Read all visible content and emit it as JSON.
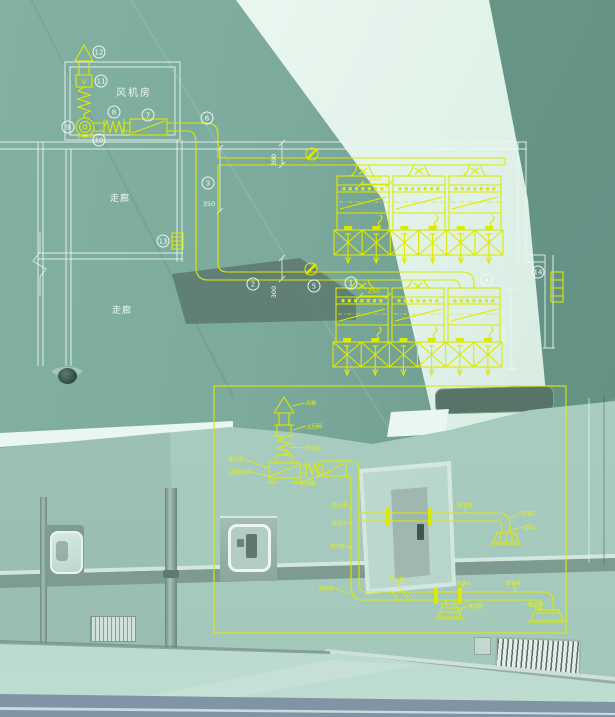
{
  "canvas": {
    "w": 615,
    "h": 717
  },
  "palette": {
    "photo_teal": "#7fae9f",
    "cad_yellow": "#dcea00",
    "cad_white": "#edf7f1"
  },
  "plan": {
    "fan_room": "风机房",
    "valve_letter": "V",
    "corridors": [
      {
        "t": "走廊",
        "x": 120,
        "y": 201
      },
      {
        "t": "走廊",
        "x": 122,
        "y": 313
      }
    ],
    "callouts": [
      {
        "n": "12",
        "x": 99,
        "y": 52
      },
      {
        "n": "11",
        "x": 101,
        "y": 81
      },
      {
        "n": "9",
        "x": 68,
        "y": 127
      },
      {
        "n": "10",
        "x": 99,
        "y": 140
      },
      {
        "n": "8",
        "x": 114,
        "y": 112
      },
      {
        "n": "7",
        "x": 148,
        "y": 115
      },
      {
        "n": "6",
        "x": 207,
        "y": 118
      },
      {
        "n": "3",
        "x": 208,
        "y": 183
      },
      {
        "n": "13",
        "x": 163,
        "y": 241
      },
      {
        "n": "2",
        "x": 253,
        "y": 284
      },
      {
        "n": "5",
        "x": 314,
        "y": 286
      },
      {
        "n": "1",
        "x": 351,
        "y": 283
      },
      {
        "n": "4",
        "x": 487,
        "y": 280
      },
      {
        "n": "14",
        "x": 538,
        "y": 272
      }
    ],
    "dims": [
      {
        "t": "350",
        "x": 209,
        "y": 206,
        "rot": 0,
        "c": "w"
      },
      {
        "t": "300",
        "x": 276,
        "y": 160,
        "rot": -90,
        "c": "w"
      },
      {
        "t": "300",
        "x": 276,
        "y": 292,
        "rot": -90,
        "c": "w"
      },
      {
        "t": "2350",
        "x": 506,
        "y": 334,
        "rot": -90,
        "c": "w"
      },
      {
        "t": "250",
        "x": 375,
        "y": 181,
        "rot": 0,
        "c": "y"
      },
      {
        "t": "250",
        "x": 374,
        "y": 293,
        "rot": 0,
        "c": "y"
      }
    ]
  },
  "detail": {
    "labels": [
      {
        "t": "风帽",
        "x": 306,
        "y": 405,
        "a": "start",
        "lx": 292,
        "ly": 406
      },
      {
        "t": "止回阀",
        "x": 307,
        "y": 428,
        "a": "start",
        "lx": 293,
        "ly": 430
      },
      {
        "t": "软接头",
        "x": 306,
        "y": 450,
        "a": "start",
        "lx": 291,
        "ly": 447
      },
      {
        "t": "排风机",
        "x": 243,
        "y": 461,
        "a": "end",
        "lx": 268,
        "ly": 468
      },
      {
        "t": "减震吊架",
        "x": 250,
        "y": 474,
        "a": "end",
        "lx": 272,
        "ly": 477
      },
      {
        "t": "防火阀",
        "x": 300,
        "y": 485,
        "a": "start",
        "lx": 330,
        "ly": 472
      },
      {
        "t": "防火阀",
        "x": 347,
        "y": 507,
        "a": "end",
        "lx": 352,
        "ly": 509
      },
      {
        "t": "软接头",
        "x": 347,
        "y": 525,
        "a": "end",
        "lx": 352,
        "ly": 523
      },
      {
        "t": "排风管",
        "x": 345,
        "y": 548,
        "a": "end",
        "lx": 352,
        "ly": 548
      },
      {
        "t": "调节阀",
        "x": 465,
        "y": 507,
        "a": "middle",
        "lx": 466,
        "ly": 513
      },
      {
        "t": "软接头",
        "x": 521,
        "y": 515,
        "a": "start",
        "lx": 511,
        "ly": 518
      },
      {
        "t": "送风口",
        "x": 523,
        "y": 529,
        "a": "start",
        "lx": 507,
        "ly": 531
      },
      {
        "t": "送风管",
        "x": 334,
        "y": 590,
        "a": "end",
        "lx": 349,
        "ly": 594
      },
      {
        "t": "防火阀",
        "x": 397,
        "y": 581,
        "a": "middle",
        "lx": 401,
        "ly": 592
      },
      {
        "t": "软接头",
        "x": 464,
        "y": 585,
        "a": "middle",
        "lx": 460,
        "ly": 590
      },
      {
        "t": "散流器",
        "x": 468,
        "y": 608,
        "a": "start",
        "lx": 457,
        "ly": 611
      },
      {
        "t": "调节阀",
        "x": 513,
        "y": 585,
        "a": "middle",
        "lx": 516,
        "ly": 592
      },
      {
        "t": "散流器",
        "x": 528,
        "y": 606,
        "a": "start",
        "lx": 546,
        "ly": 611
      }
    ]
  }
}
